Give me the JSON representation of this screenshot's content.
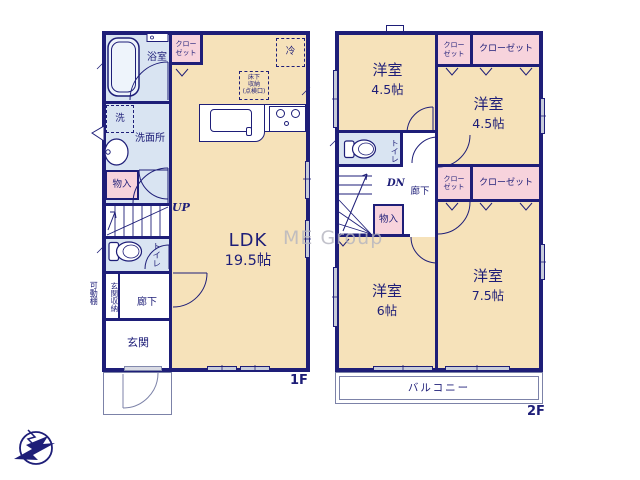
{
  "watermark": "ME Group",
  "f1": {
    "floor_label": "1F",
    "bathroom_label": "浴室",
    "washer_label": "洗",
    "washroom_label": "洗面所",
    "storage_label": "物入",
    "closet_line1": "クロー",
    "closet_line2": "ゼット",
    "up_label": "UP",
    "toilet_label": "トイレ",
    "entrance_storage_label": "玄関収納",
    "hallway_label": "廊下",
    "entrance_label": "玄関",
    "movable_shelf_label": "可動棚",
    "ldk_label": "LDK",
    "ldk_size": "19.5帖",
    "fridge_label": "冷",
    "underfloor_line1": "床下",
    "underfloor_line2": "収納",
    "underfloor_line3": "(点検口)"
  },
  "f2": {
    "floor_label": "2F",
    "rooms": [
      {
        "name": "洋室",
        "size": "4.5帖"
      },
      {
        "name": "洋室",
        "size": "4.5帖"
      },
      {
        "name": "洋室",
        "size": "6帖"
      },
      {
        "name": "洋室",
        "size": "7.5帖"
      }
    ],
    "closet_small_line1": "クロー",
    "closet_small_line2": "ゼット",
    "closet_wide_label": "クローゼット",
    "toilet_label": "トイレ",
    "dn_label": "DN",
    "hallway_label": "廊下",
    "storage_label": "物入",
    "balcony_label": "バルコニー"
  },
  "colors": {
    "wall": "#1e1e78",
    "room": "#f6e2ba",
    "wet_area": "#d9e4f2",
    "closet": "#f7d3dc",
    "window": "#c7ccd9",
    "watermark": "#b4b4bf"
  }
}
